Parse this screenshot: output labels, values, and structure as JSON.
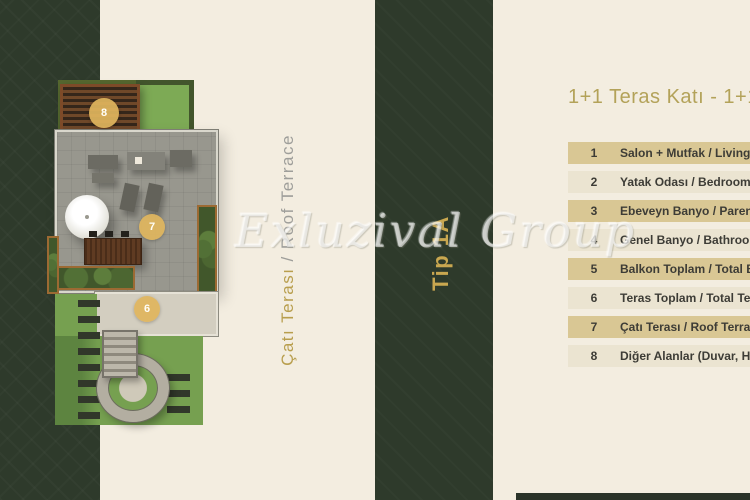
{
  "colors": {
    "page_background": "#f3ede0",
    "panel_green": "#2e3a2b",
    "row_odd": "#d9c794",
    "row_even": "#ebe4d1",
    "gold_accent": "#c9a750",
    "badge_gold": "#dfb55d",
    "title_gold": "#b3a259"
  },
  "floor_plan": {
    "badges": [
      {
        "value": "8"
      },
      {
        "value": "7"
      },
      {
        "value": "6"
      }
    ],
    "vertical_label": {
      "turkish": "Çatı Terası",
      "english": "/ Roof Terrace"
    }
  },
  "type_strip": {
    "label": "Tip 1A"
  },
  "watermark": {
    "text": "Exluzival Group"
  },
  "legend": {
    "title": "1+1 Teras Katı - 1+1 Teras Katı",
    "rows": [
      {
        "no": "1",
        "label": "Salon + Mutfak / Living Room"
      },
      {
        "no": "2",
        "label": "Yatak Odası / Bedroom"
      },
      {
        "no": "3",
        "label": "Ebeveyn Banyo / Parent Bathroom"
      },
      {
        "no": "4",
        "label": "Genel Banyo / Bathroom"
      },
      {
        "no": "5",
        "label": "Balkon Toplam / Total Balcony"
      },
      {
        "no": "6",
        "label": "Teras Toplam / Total Terrace"
      },
      {
        "no": "7",
        "label": "Çatı Terası / Roof Terrace"
      },
      {
        "no": "8",
        "label": "Diğer Alanlar (Duvar, Havalandırma)"
      }
    ]
  }
}
